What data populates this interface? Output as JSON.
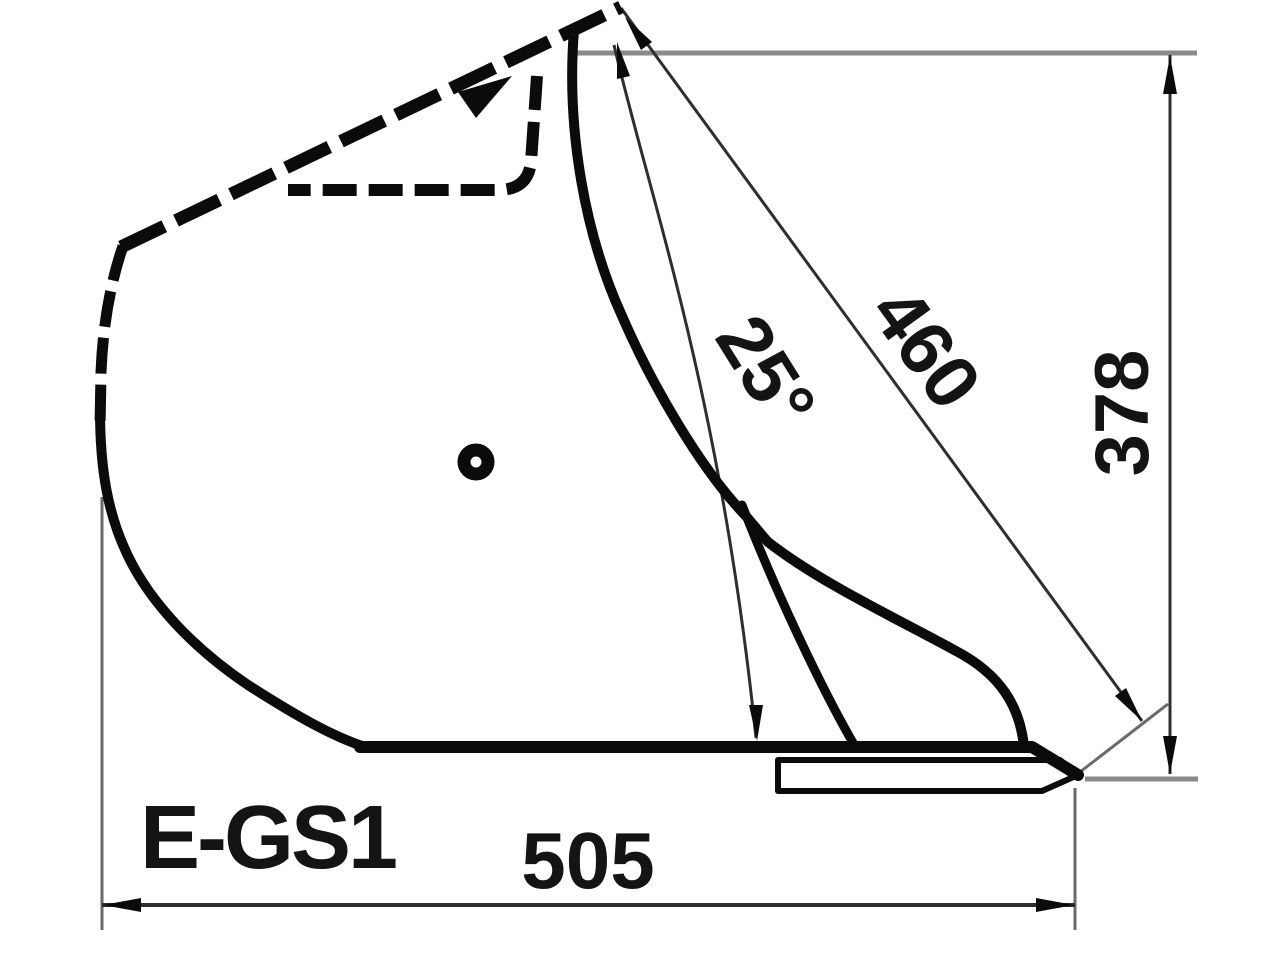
{
  "drawing": {
    "model_label": "E-GS1",
    "dimensions": {
      "bottom_width": "505",
      "diagonal_length": "460",
      "overall_height": "378",
      "opening_angle": "25°"
    },
    "colors": {
      "background": "#ffffff",
      "outline": "#0b0b0b",
      "dimension_line": "#2e2e2e",
      "reference_line": "#8a8a8a",
      "text": "#141414"
    }
  }
}
